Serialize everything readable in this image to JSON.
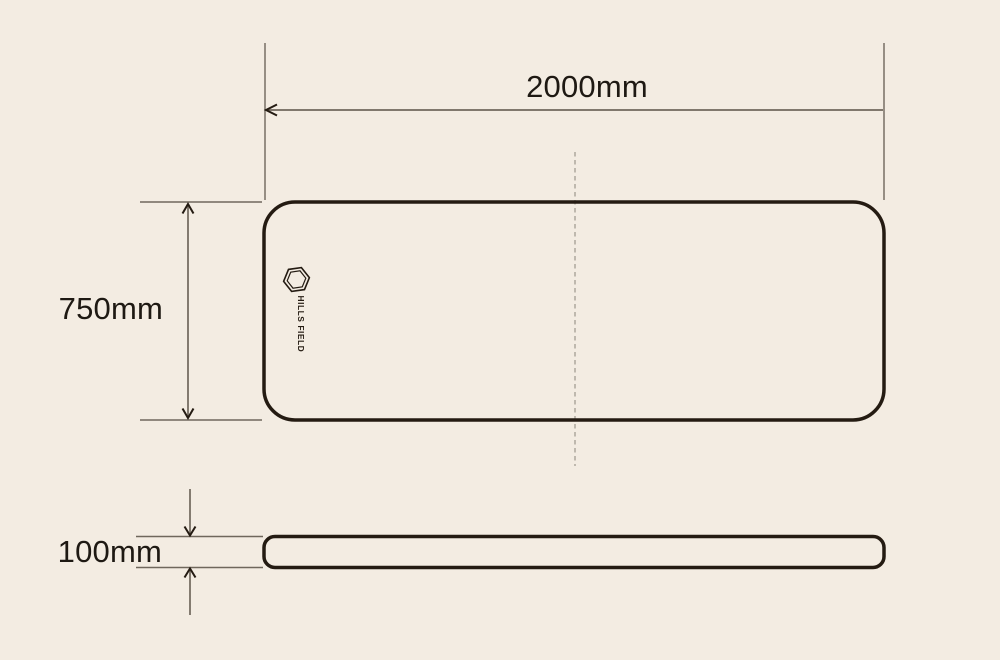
{
  "canvas": {
    "width_px": 1000,
    "height_px": 660,
    "background_color": "#f3ece2"
  },
  "colors": {
    "outline": "#241b12",
    "dimension_line": "#6f675c",
    "arrowhead": "#241b12",
    "label_text": "#1e1913",
    "centerline": "#b9b3a8"
  },
  "diagram": {
    "type": "product dimension drawing (top view and side view)",
    "dimensions": {
      "width": {
        "label": "2000mm"
      },
      "depth": {
        "label": "750mm"
      },
      "height": {
        "label": "100mm"
      }
    },
    "logo": {
      "text": "HILLS FIELD",
      "icon": "hexagon-icon"
    }
  }
}
